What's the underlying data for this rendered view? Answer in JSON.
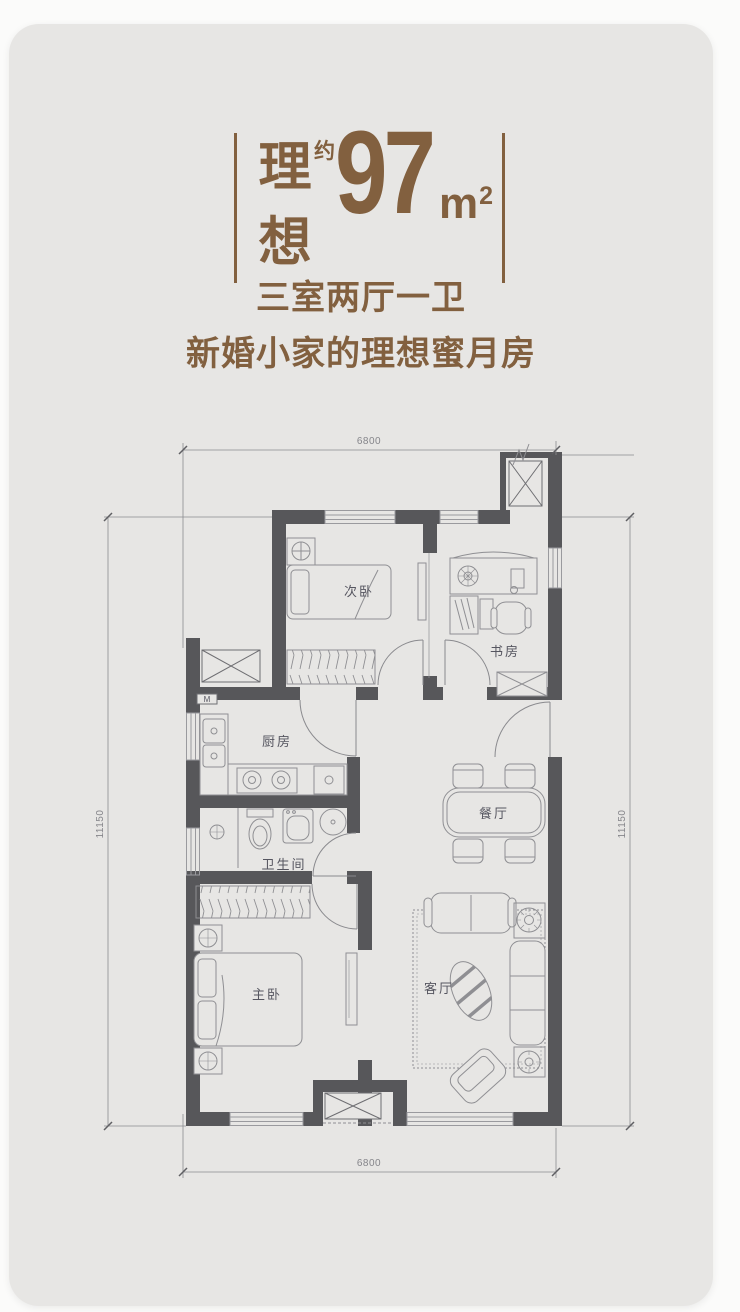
{
  "header": {
    "title_chars": [
      "理",
      "想"
    ],
    "approx": "约",
    "area_value": "97",
    "unit_base": "m",
    "unit_exp": "2",
    "subtitle_line1": "三室两厅一卫",
    "subtitle_line2": "新婚小家的理想蜜月房"
  },
  "colors": {
    "accent_brown": "#82603F",
    "wall_gray": "#57575A",
    "card_background": "#E7E6E4",
    "furniture_line": "#8F8F93"
  },
  "floorplan": {
    "rooms": [
      {
        "key": "secondary-bedroom",
        "label": "次卧"
      },
      {
        "key": "study",
        "label": "书房"
      },
      {
        "key": "kitchen",
        "label": "厨房"
      },
      {
        "key": "dining-room",
        "label": "餐厅"
      },
      {
        "key": "bathroom",
        "label": "卫生间"
      },
      {
        "key": "master-bedroom",
        "label": "主卧"
      },
      {
        "key": "living-room",
        "label": "客厅"
      }
    ],
    "dimensions": {
      "top": "6800",
      "bottom": "6800",
      "left": "11150",
      "right": "11150"
    },
    "meter_box": "M"
  }
}
